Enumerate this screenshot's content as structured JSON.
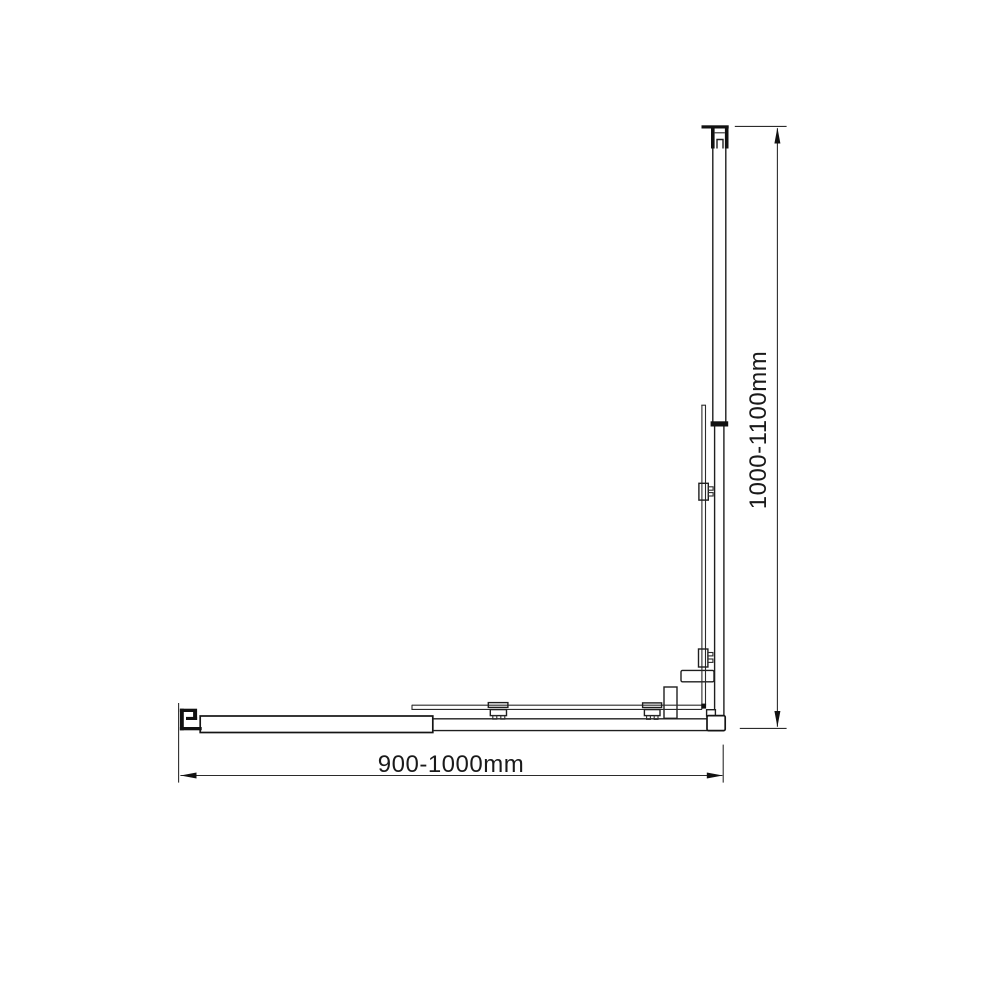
{
  "diagram": {
    "background_color": "#ffffff",
    "line_color": "#1e1e1e",
    "horizontal_dimension": {
      "label": "900-1000mm"
    },
    "vertical_dimension": {
      "label": "1000-1100mm"
    }
  }
}
